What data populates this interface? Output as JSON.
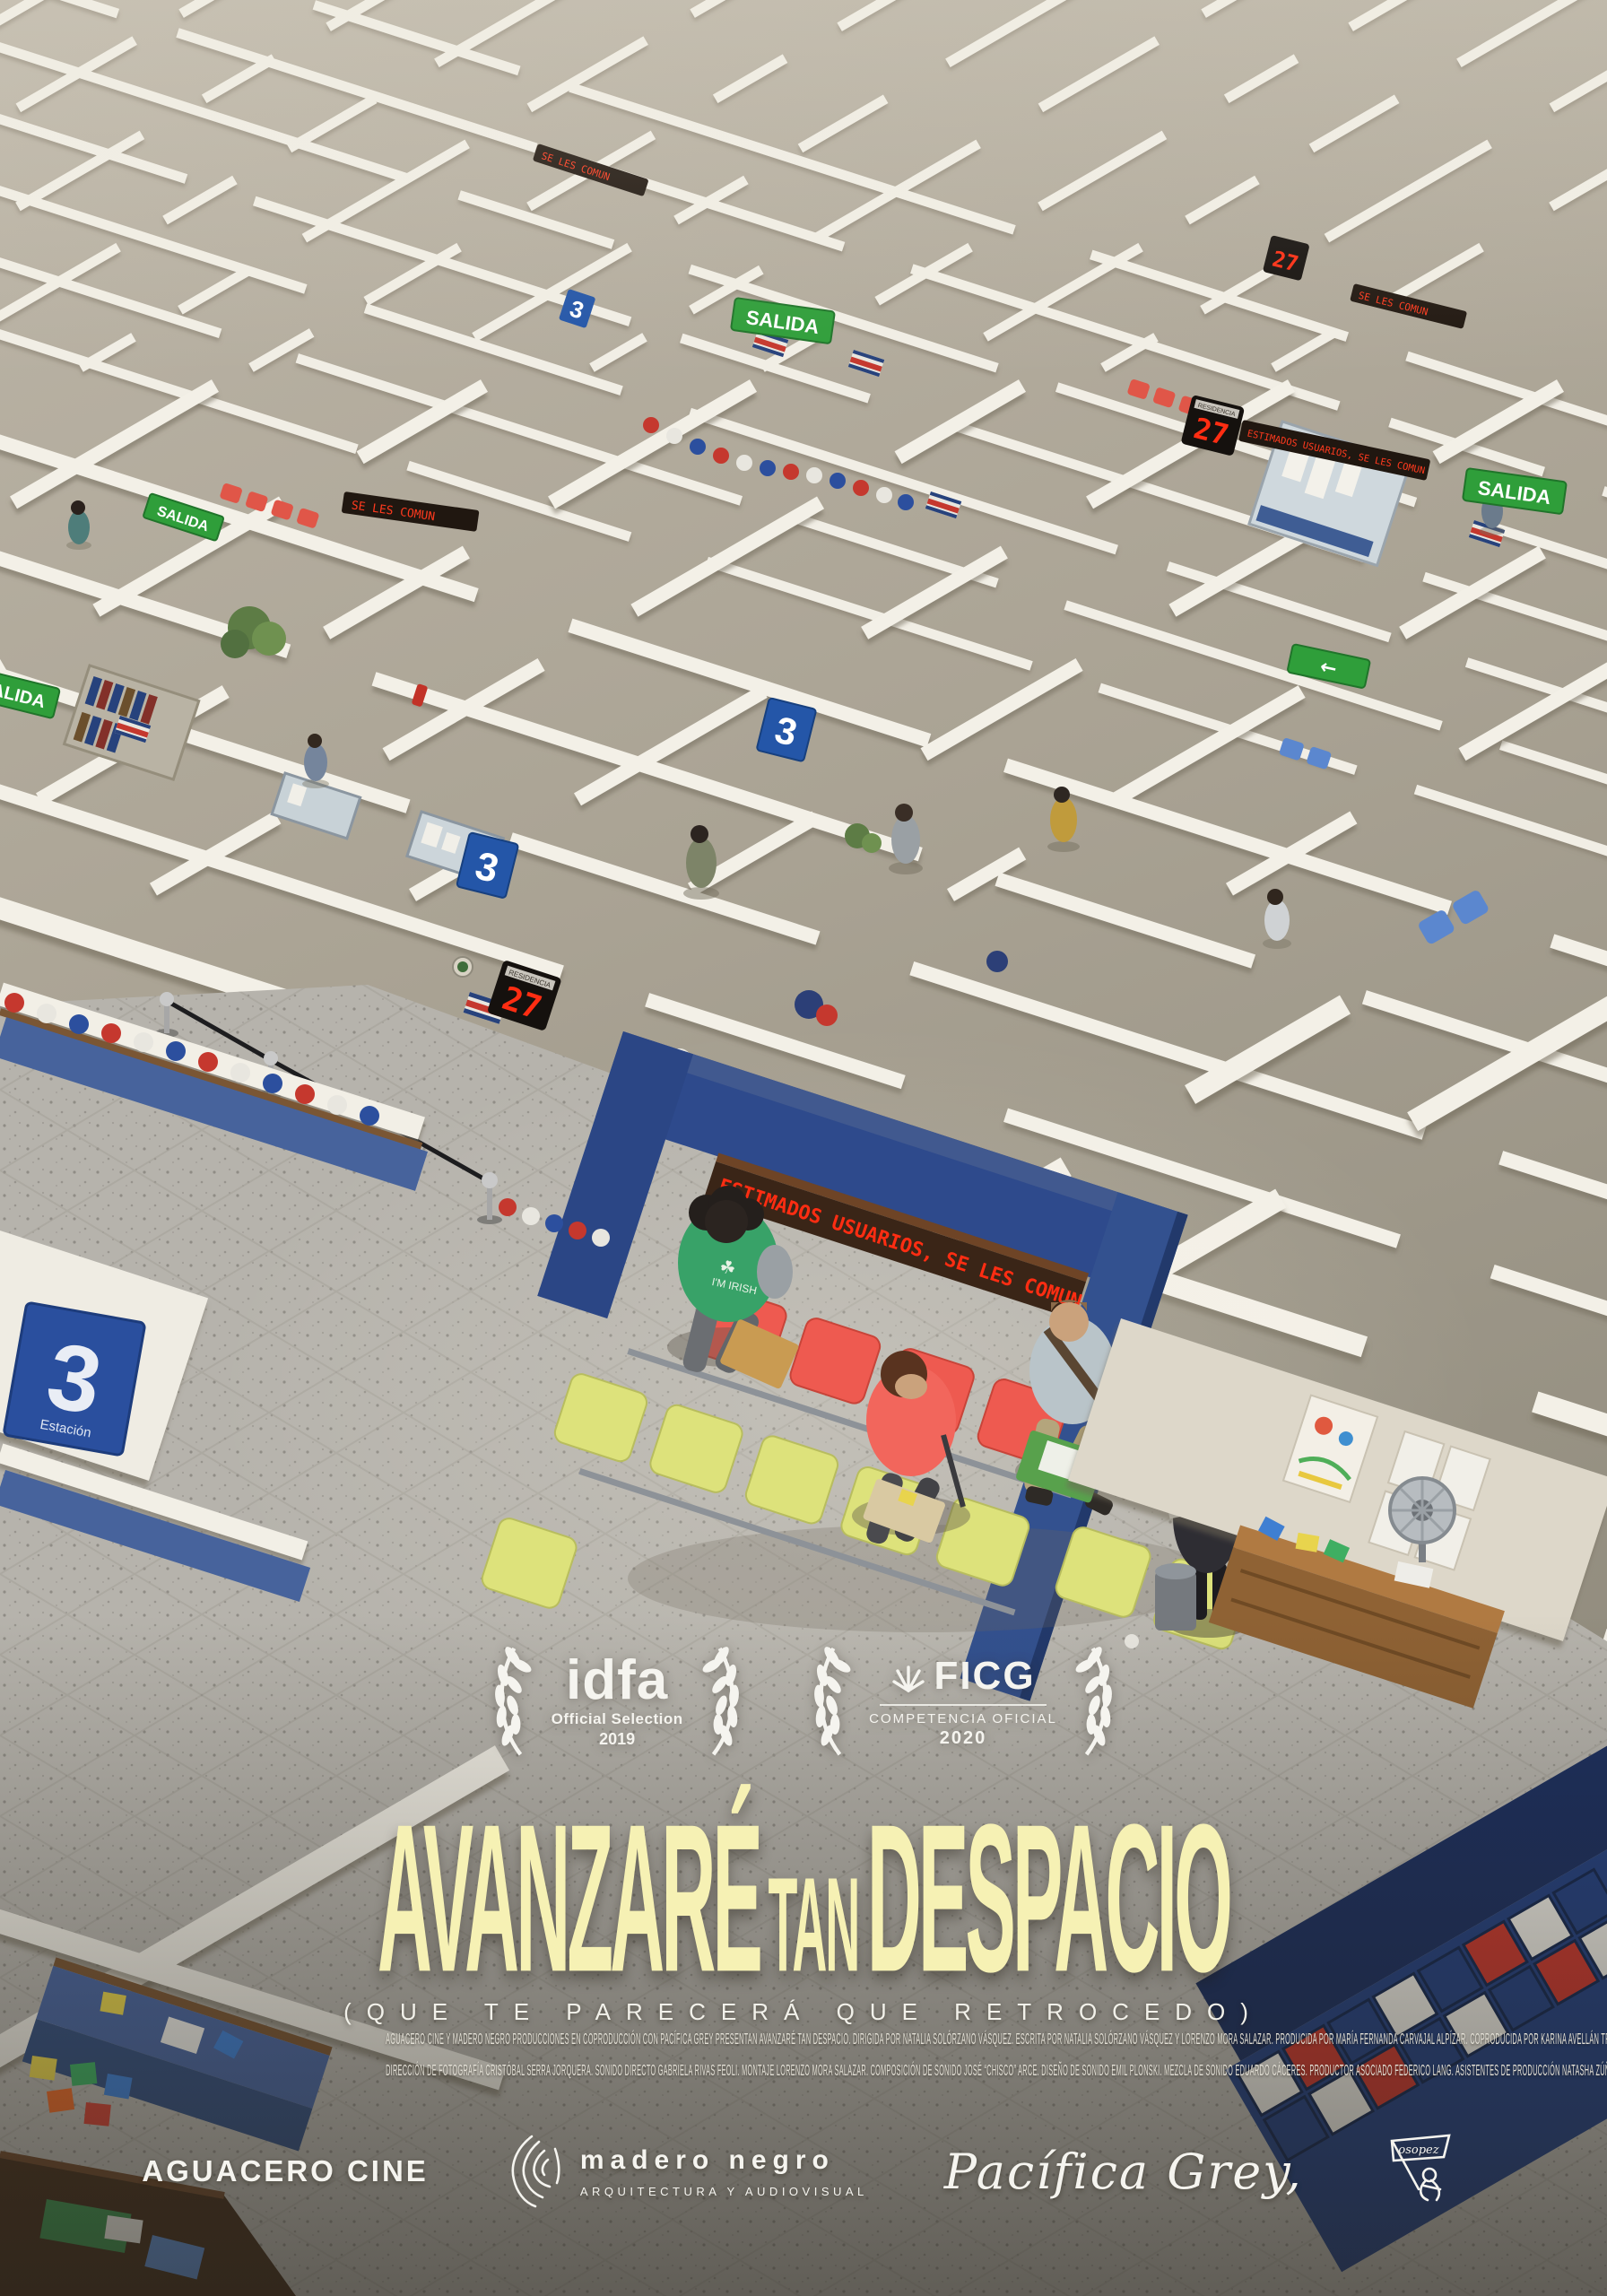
{
  "poster": {
    "laurels": [
      {
        "name": "idfa",
        "line1": "Official Selection",
        "line2": "2019"
      },
      {
        "name": "FICG",
        "line1": "COMPETENCIA OFICIAL",
        "line2": "2020"
      }
    ],
    "title": {
      "part1": "AVANZARÉ",
      "part2": "TAN",
      "part3": "DESPACIO"
    },
    "subtitle": "(QUE TE PARECERÁ QUE RETROCEDO)",
    "credits": {
      "line1": "AGUACERO CINE Y MADERO NEGRO PRODUCCIONES  EN COPRODUCCIÓN CON PACÍFICA GREY  PRESENTAN  AVANZARÉ TAN DESPACIO.  DIRIGIDA POR NATALIA SOLÓRZANO VÁSQUEZ.  ESCRITA POR NATALIA SOLÓRZANO VÁSQUEZ Y LORENZO MORA SALAZAR.  PRODUCIDA POR MARÍA FERNANDA CARVAJAL ALPÍZAR.  COPRODUCIDA POR KARINA AVELLÁN TROZ.",
      "line2": "DIRECCIÓN DE FOTOGRAFÍA CRISTÓBAL SERRA JORQUERA.  SONIDO DIRECTO GABRIELA RIVAS FEOLI.  MONTAJE LORENZO MORA SALAZAR.  COMPOSICIÓN DE SONIDO JOSÉ “CHISCO” ARCE.  DISEÑO DE SONIDO EMIL PLONSKI.  MEZCLA DE SONIDO EDUARDO CÁCERES.  PRODUCTOR ASOCIADO FEDERICO LANG.  ASISTENTES DE PRODUCCIÓN NATASHA ZÚÑIGA Y PABLO FLORES.  ASISTENTE DE FOTOGRAFÍA Y SEGUNDA UNIDAD PÁVEL QUEVEDO.  AFICHE Y CRÉDITOS OSOPEZ.  COSTA RICA 2019"
    },
    "logos": {
      "aguacero": "AGUACERO CINE",
      "madero_name": "madero negro",
      "madero_sub": "ARQUITECTURA Y AUDIOVISUAL",
      "pacifica": "Pacífica Grey,",
      "osopez": "osopez"
    }
  },
  "scene": {
    "marquee_text": "ESTIMADOS USUARIOS, SE LES COMUN",
    "ticker_short": "SE LES COMUN",
    "exit_sign": "SALIDA",
    "arrow_glyph": "←",
    "station_number": "3",
    "station_label": "Estación",
    "queue_number": "27",
    "queue_label": "RESIDENCIA",
    "tshirt_text": "I'M IRISH"
  },
  "colors": {
    "title_yellow": "#f6f1b4",
    "led_red": "#ff2d12",
    "arch_blue": "#2e4a8c",
    "exit_green": "#2f9e3a",
    "sign_blue": "#2456a8",
    "chair_yellow": "#dde27b",
    "chair_red": "#ee5a50"
  }
}
